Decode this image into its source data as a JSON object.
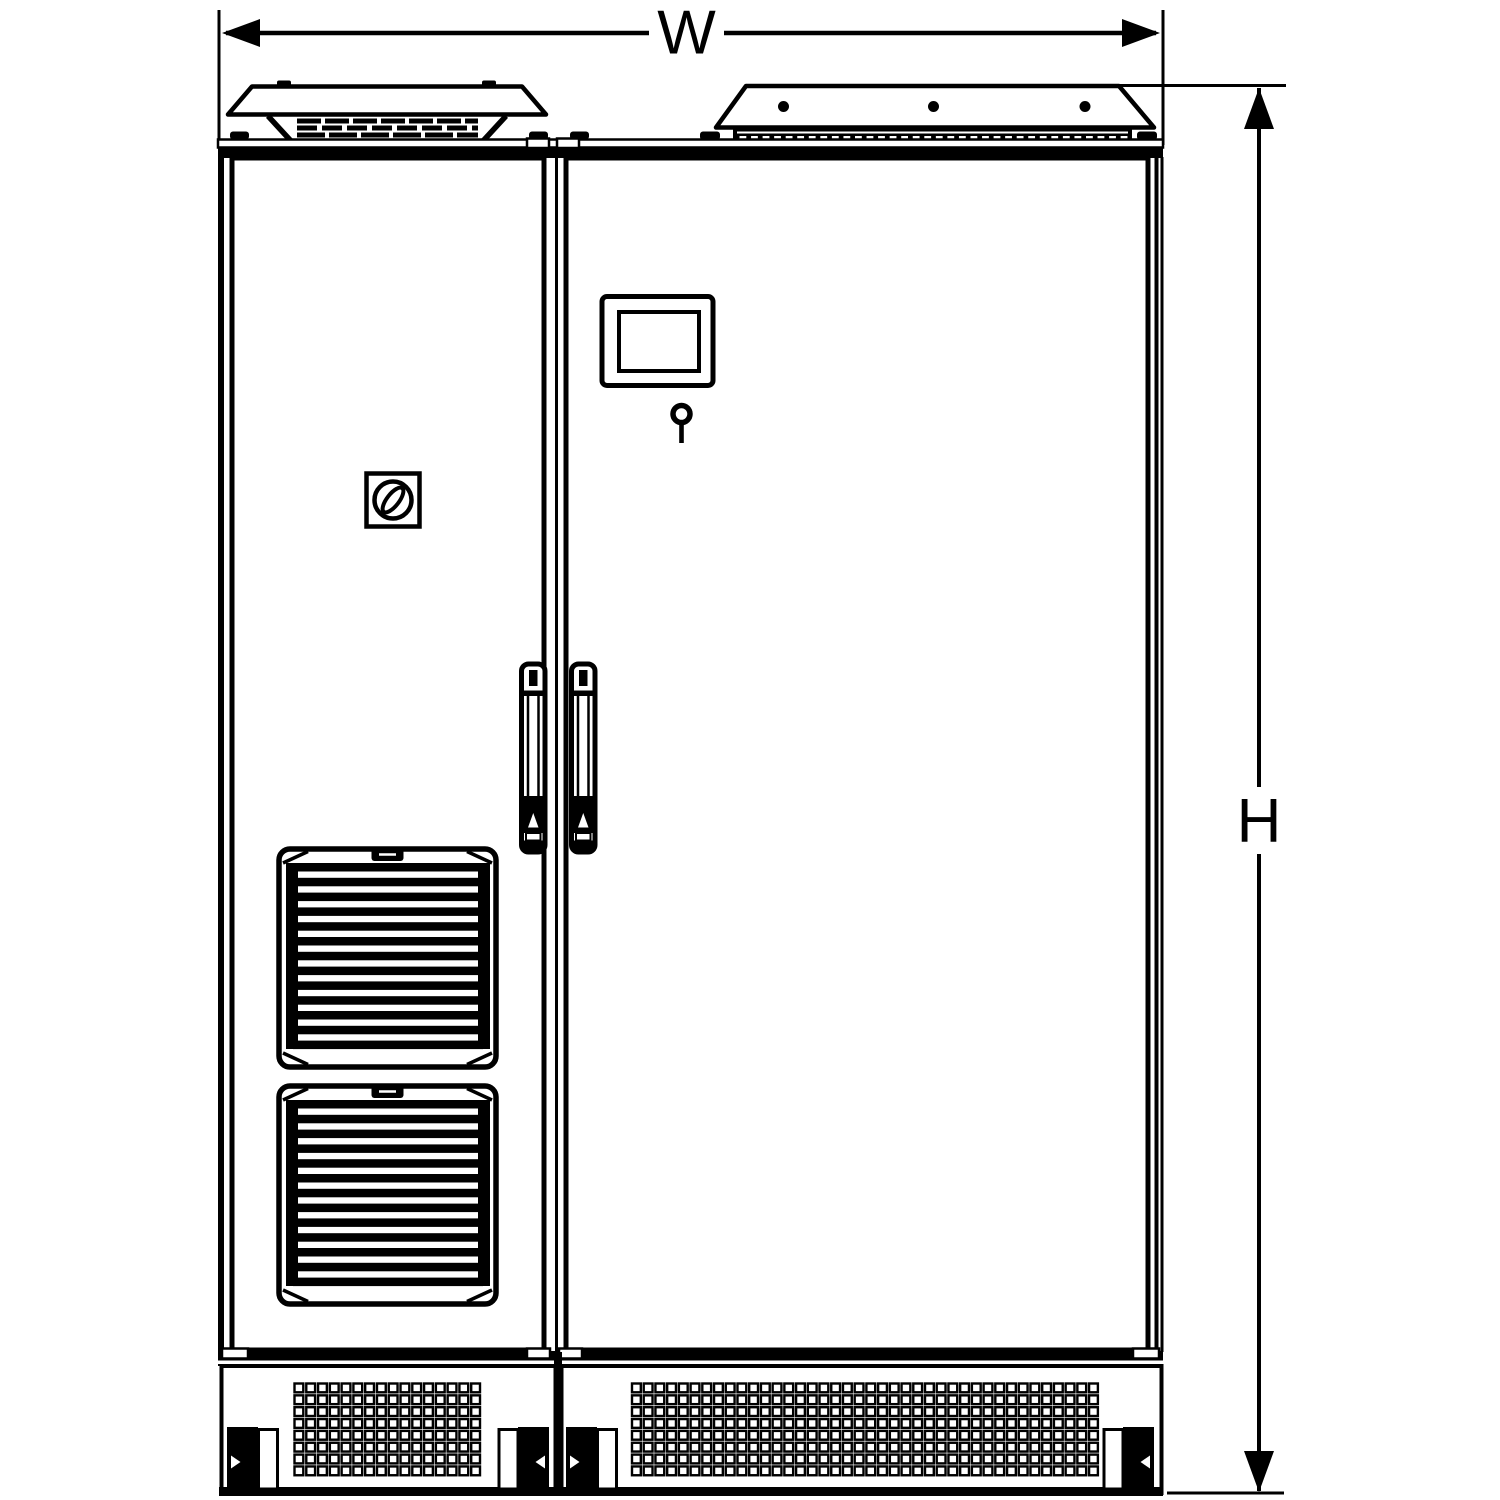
{
  "drawing": {
    "type": "enclosure-front-view-dimension-drawing",
    "dimensions": {
      "width_label": "W",
      "height_label": "H"
    },
    "colors": {
      "ink": "#000000",
      "paper": "#ffffff"
    },
    "icons": {
      "rotary_switch": "rotary-disconnect-switch-icon",
      "hmi_panel": "hmi-display-panel-icon",
      "key_lock": "door-key-lock-icon",
      "door_handles": "vertical-swing-handle-icon",
      "fan_filter": "louvered-fan-filter-icon",
      "roof_hood_left": "roof-fan-hood-icon",
      "roof_hood_right": "top-entry-gland-plate-icon",
      "plinth": "perforated-plinth-vent-icon",
      "dimension_arrows": "dimension-arrow-icon"
    }
  }
}
